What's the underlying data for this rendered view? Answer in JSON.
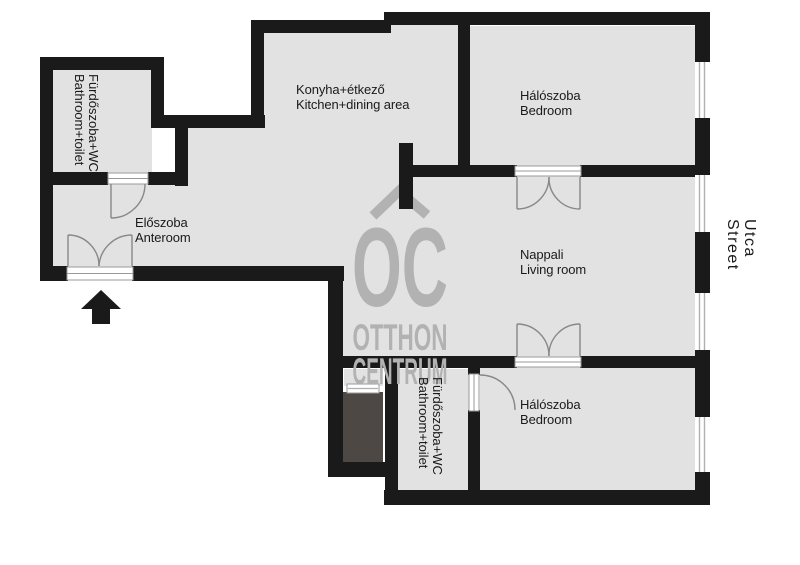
{
  "title": "Apartment floor plan",
  "colors": {
    "wall": "#1a1a1a",
    "floor": "#e2e2e2",
    "balcony_shaft": "#4d4843",
    "door_line": "#888888",
    "window_line": "#b0b0b0",
    "watermark": "#b2b2b2",
    "label_text": "#1a1a1a"
  },
  "rooms": {
    "bathroom1": {
      "hu": "Fürdőszoba+WC",
      "en": "Bathroom+toilet"
    },
    "anteroom": {
      "hu": "Előszoba",
      "en": "Anteroom"
    },
    "kitchen": {
      "hu": "Konyha+étkező",
      "en": "Kitchen+dining area"
    },
    "bedroom1": {
      "hu": "Hálószoba",
      "en": "Bedroom"
    },
    "living": {
      "hu": "Nappali",
      "en": "Living room"
    },
    "bathroom2": {
      "hu": "Fürdőszoba+WC",
      "en": "Bathroom+toilet"
    },
    "bedroom2": {
      "hu": "Hálószoba",
      "en": "Bedroom"
    }
  },
  "street": {
    "hu": "Utca",
    "en": "Street"
  },
  "watermark": {
    "monogram": "OC",
    "word1": "OTTHON",
    "word2": "CENTRUM"
  }
}
